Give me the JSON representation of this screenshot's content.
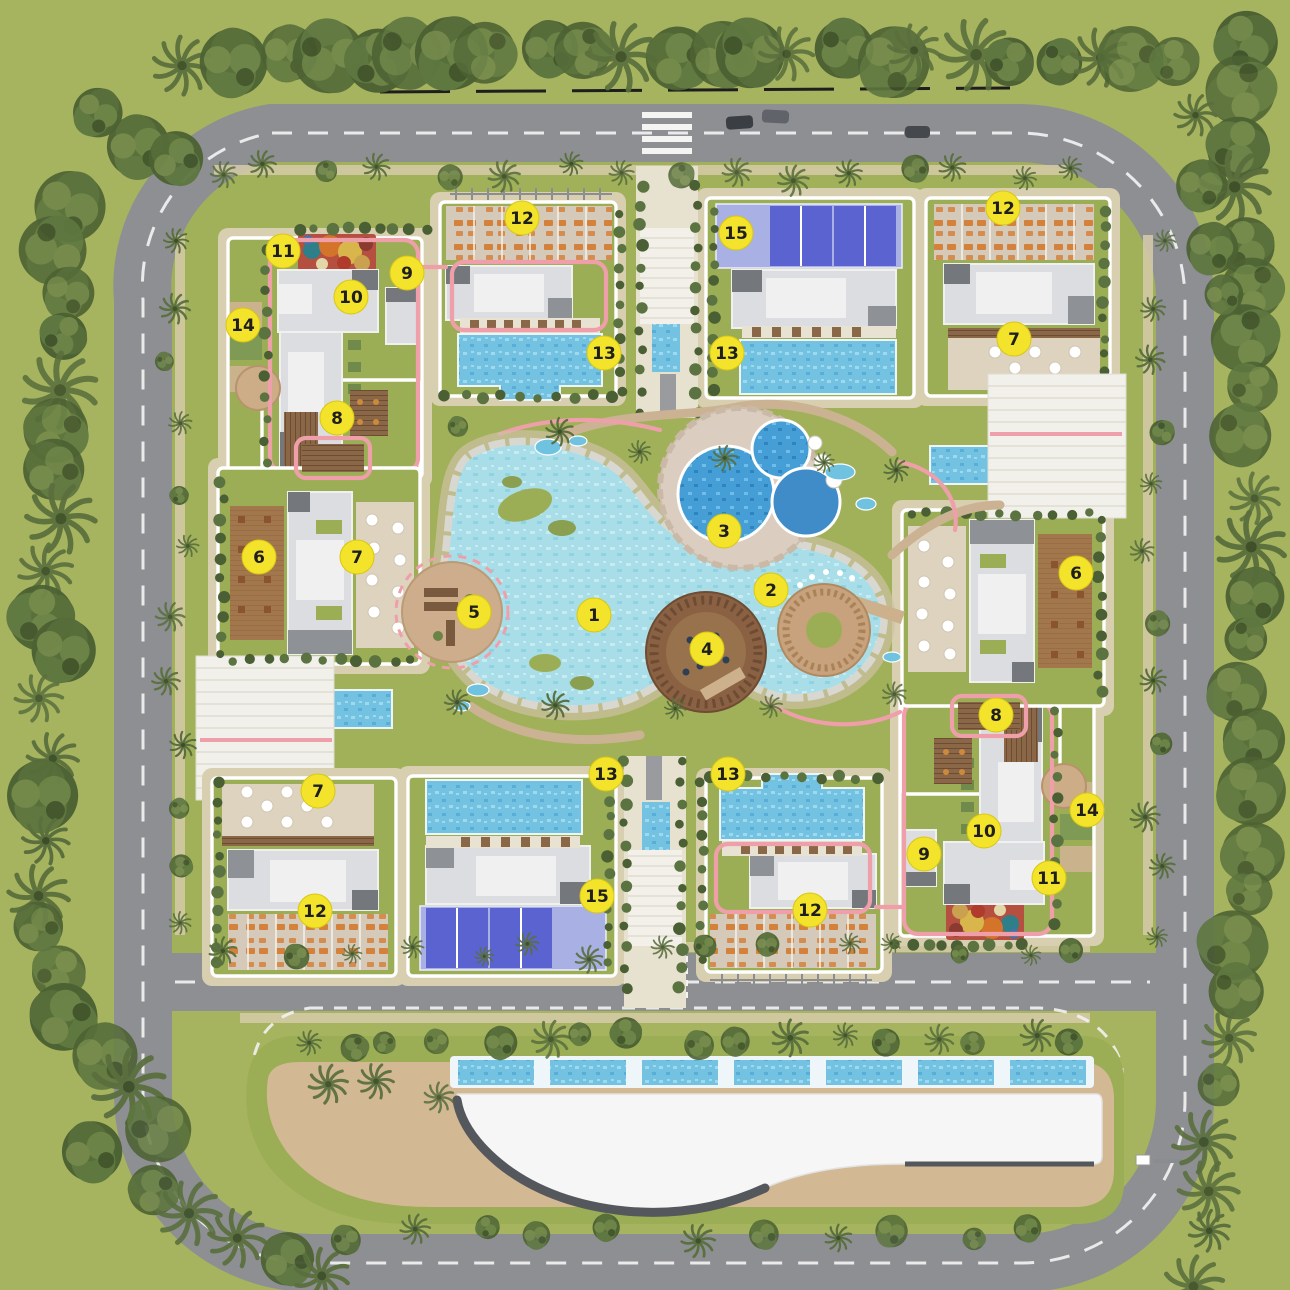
{
  "plan": {
    "kind": "residential-compound-master-plan",
    "description": "top-down landscaped site plan with ring road, four residential clusters, central lagoon pool and curved clubhouse building"
  },
  "markers": [
    {
      "label": "1",
      "x": 594,
      "y": 615
    },
    {
      "label": "2",
      "x": 771,
      "y": 590
    },
    {
      "label": "3",
      "x": 724,
      "y": 531
    },
    {
      "label": "4",
      "x": 707,
      "y": 649
    },
    {
      "label": "5",
      "x": 474,
      "y": 612
    },
    {
      "label": "6",
      "x": 259,
      "y": 557
    },
    {
      "label": "6",
      "x": 1076,
      "y": 573
    },
    {
      "label": "7",
      "x": 357,
      "y": 557
    },
    {
      "label": "7",
      "x": 1014,
      "y": 339
    },
    {
      "label": "7",
      "x": 318,
      "y": 791
    },
    {
      "label": "8",
      "x": 337,
      "y": 418
    },
    {
      "label": "8",
      "x": 996,
      "y": 715
    },
    {
      "label": "9",
      "x": 407,
      "y": 273
    },
    {
      "label": "9",
      "x": 924,
      "y": 854
    },
    {
      "label": "10",
      "x": 351,
      "y": 297
    },
    {
      "label": "10",
      "x": 984,
      "y": 831
    },
    {
      "label": "11",
      "x": 283,
      "y": 251
    },
    {
      "label": "11",
      "x": 1049,
      "y": 878
    },
    {
      "label": "12",
      "x": 522,
      "y": 218
    },
    {
      "label": "12",
      "x": 1003,
      "y": 208
    },
    {
      "label": "12",
      "x": 315,
      "y": 911
    },
    {
      "label": "12",
      "x": 810,
      "y": 910
    },
    {
      "label": "13",
      "x": 604,
      "y": 353
    },
    {
      "label": "13",
      "x": 727,
      "y": 353
    },
    {
      "label": "13",
      "x": 606,
      "y": 774
    },
    {
      "label": "13",
      "x": 728,
      "y": 774
    },
    {
      "label": "14",
      "x": 243,
      "y": 325
    },
    {
      "label": "14",
      "x": 1087,
      "y": 810
    },
    {
      "label": "15",
      "x": 736,
      "y": 233
    },
    {
      "label": "15",
      "x": 597,
      "y": 896
    }
  ],
  "colors": {
    "marker_fill": "#f3e32b",
    "marker_text": "#1f1f1f",
    "road": "#8d8f92",
    "dash": "#f2f2f2",
    "lawn": "#a6b35f",
    "plot_lawn": "#9cae55",
    "sand": "#d6cbaa",
    "apron": "#d8cfb0",
    "white_outline": "#ffffff",
    "building": "#dcdde0",
    "building_light": "#f0f0f1",
    "building_dark": "#74787d",
    "water_light": "#a9dee9",
    "water": "#74c2e2",
    "water_deep": "#459fd6",
    "pink": "#ef9fa9",
    "deck": "#8a6746",
    "terracotta": "#b08050",
    "court_light": "#a9b1e4",
    "court_dark": "#5a63cf",
    "parking_mark": "#d4813c",
    "parking_base": "#d5caba",
    "tan_terrace": "#ded3be",
    "tree_dark": "#4d6233",
    "hedge": "#4a5f33",
    "island_path": "#d2b893",
    "clubhouse_white": "#f6f6f6",
    "clubhouse_band": "#54575b"
  }
}
